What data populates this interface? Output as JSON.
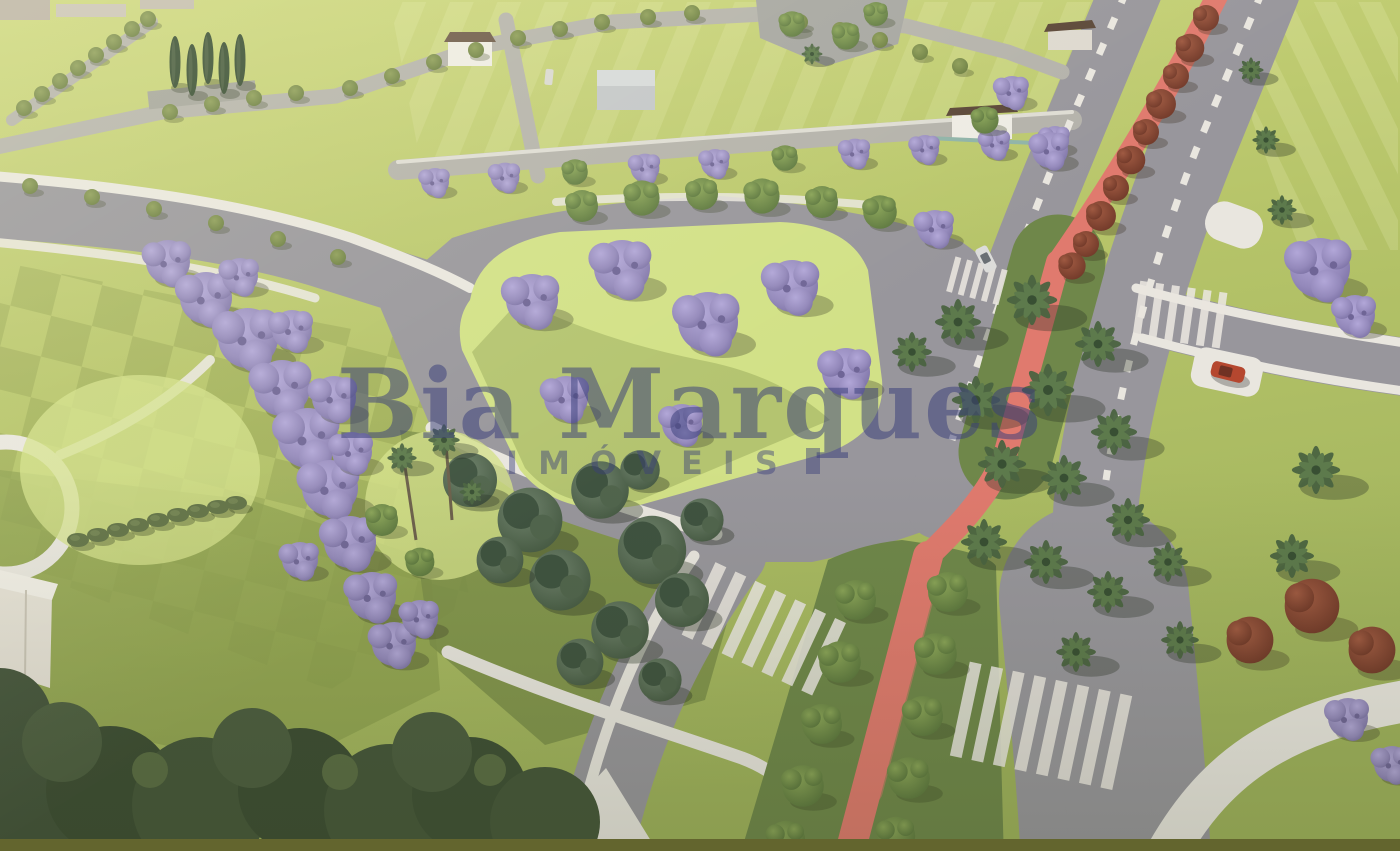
{
  "watermark": {
    "brand": "Bia Marques",
    "tagline": "IMÓVEIS"
  },
  "colors": {
    "grass_light": "#cbd579",
    "grass_mid": "#b3c268",
    "grass_dark": "#93a455",
    "grass_olive": "#8ba04e",
    "island_green": "#d2e187",
    "road_grey": "#98969c",
    "road_light": "#b4b2ab",
    "road_dark": "#807f86",
    "sidewalk_white": "#e9e6df",
    "bike_lane_red": "#e07a6e",
    "bike_lane_light": "#ef9a8b",
    "median_green": "#6f874a",
    "jacaranda_purple": "#9489bb",
    "jacaranda_light": "#b0a5d8",
    "palm_green": "#4e6742",
    "conifer_green": "#5a6f57",
    "tree_green": "#6f8c49",
    "tree_red": "#8f4d39",
    "cypress_green": "#33492f",
    "hedge_green": "#5e6f43",
    "building_white": "#eeebe4",
    "roof_brown": "#5a4637",
    "roof_grey": "#c3c6c9",
    "car_red": "#b5472f",
    "car_white": "#dcdcda",
    "watermark_navy": "#3a3f7b",
    "bottom_band": "#63652e"
  }
}
